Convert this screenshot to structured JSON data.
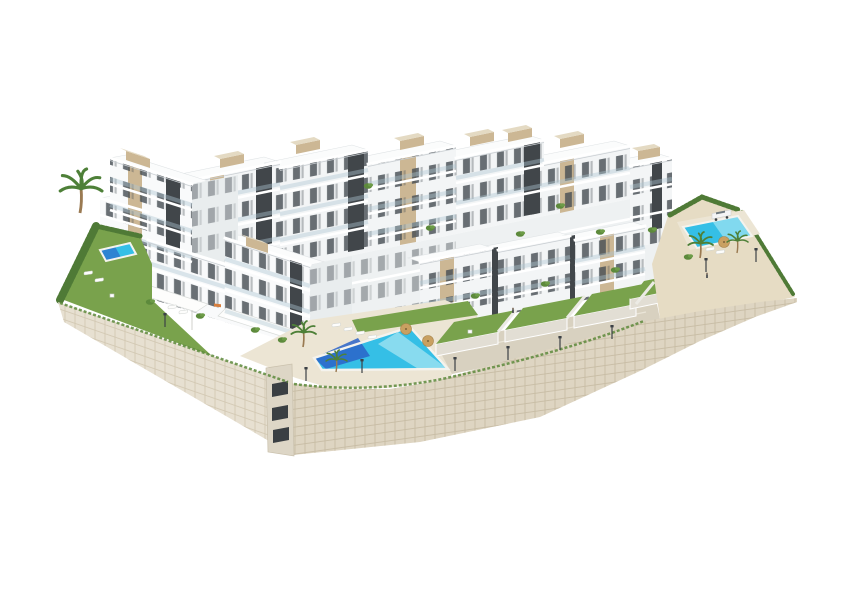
{
  "scene": {
    "type": "architectural-3d-render",
    "description": "Aerial 3D rendering of a modern white residential apartment complex built on a terraced slope, with a large communal swimming pool, two smaller pools, private lawn gardens, palm trees, street lamps, a parked car and a curved stone retaining wall, isolated on a plain white background.",
    "background_color": "#ffffff"
  },
  "palette": {
    "background": "#ffffff",
    "facade_white": "#f9fafb",
    "facade_shaded": "#f3f5f6",
    "facade_side": "#e9edee",
    "roof_white": "#fbfcfc",
    "accent_charcoal": "#41464a",
    "accent_beige": "#ccb794",
    "window_dark": "#454c52",
    "balustrade_glass": "#adc6d2",
    "lawn_green": "#79a24c",
    "hedge_green": "#4f7a36",
    "pool_turquoise": "#35bfe6",
    "pool_deep_blue": "#2a63c8",
    "pool_pale": "#bfeef5",
    "pool_rim": "#f4f3ee",
    "deck_paving": "#ece5d4",
    "terrace_paving": "#d8d1c0",
    "sand_ground": "#e6dcc4",
    "stone_wall_light": "#e7e0d1",
    "stone_wall_front": "#ded5c2",
    "palm_green": "#4e8038",
    "tree_trunk": "#9a7a52",
    "lamp_metal": "#3c4146",
    "car_white": "#f4f5f5"
  },
  "inventory": {
    "building_blocks": 13,
    "swimming_pools": 3,
    "communal_pool": "large wedge-shaped pool, lower centre",
    "side_pools": "small pool on left lawn, small pool on right sand terrace",
    "garden_plots": 5,
    "rooftop_structures": 9,
    "palm_trees": 5,
    "sun_loungers": 10,
    "parasols": 3,
    "street_lamps": 9,
    "garden_tables": 2,
    "orange_daybeds": 1,
    "parked_cars": 1,
    "people": 2
  }
}
